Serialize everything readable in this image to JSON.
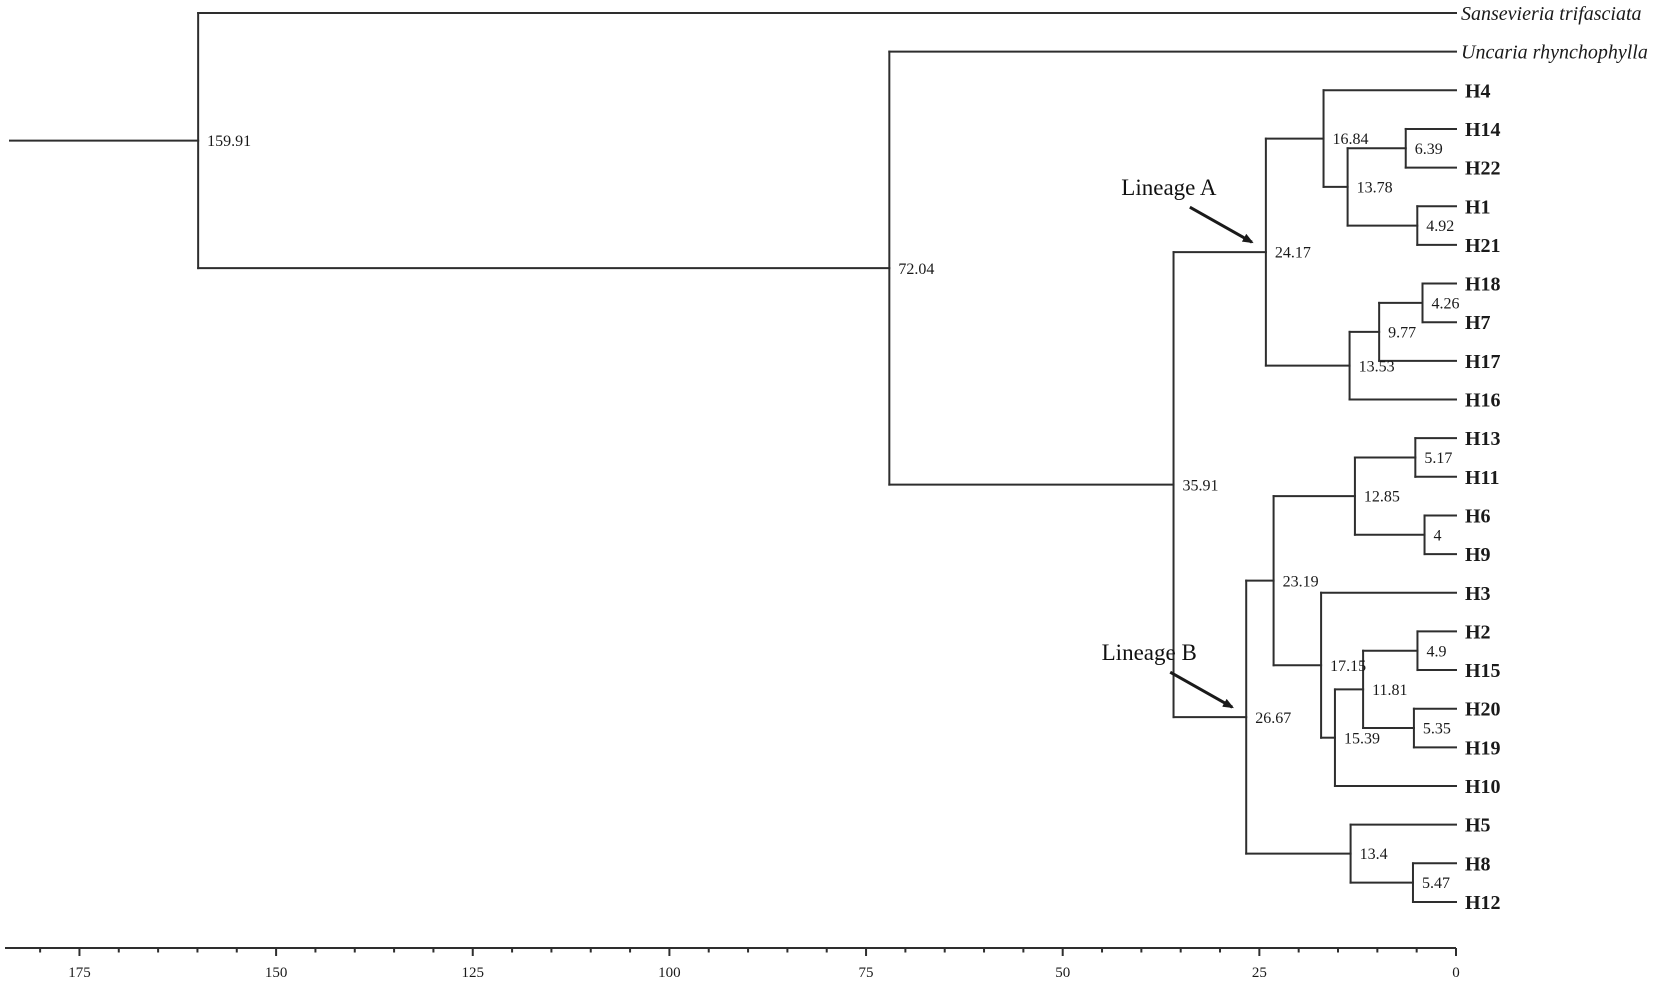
{
  "figure_type": "phylogenetic-tree",
  "colors": {
    "background": "#ffffff",
    "line": "#2e2e2e",
    "text": "#1a1a1a"
  },
  "chart_data": {
    "type": "dendrogram",
    "orientation": "right-facing, time axis decreasing to 0 at tips",
    "axis": {
      "major_ticks": [
        175,
        150,
        125,
        100,
        75,
        50,
        25,
        0
      ],
      "minor_step": 5,
      "minor_max": 180,
      "min": 0,
      "max": 175
    },
    "annotations": [
      {
        "text": "Lineage A",
        "target_label": "24.17"
      },
      {
        "text": "Lineage B",
        "target_label": "26.67"
      }
    ],
    "tip_order": [
      "Sansevieria trifasciata",
      "Uncaria rhynchophylla",
      "H4",
      "H14",
      "H22",
      "H1",
      "H21",
      "H18",
      "H7",
      "H17",
      "H16",
      "H13",
      "H11",
      "H6",
      "H9",
      "H3",
      "H2",
      "H15",
      "H20",
      "H19",
      "H10",
      "H5",
      "H8",
      "H12"
    ],
    "tree": {
      "age": 159.91,
      "label": "159.91",
      "children": [
        {
          "name": "Sansevieria trifasciata",
          "style": "italic"
        },
        {
          "age": 72.04,
          "label": "72.04",
          "children": [
            {
              "name": "Uncaria rhynchophylla",
              "style": "italic"
            },
            {
              "age": 35.91,
              "label": "35.91",
              "children": [
                {
                  "age": 24.17,
                  "label": "24.17",
                  "children": [
                    {
                      "age": 16.84,
                      "label": "16.84",
                      "children": [
                        {
                          "name": "H4"
                        },
                        {
                          "age": 13.78,
                          "label": "13.78",
                          "children": [
                            {
                              "age": 6.39,
                              "label": "6.39",
                              "children": [
                                {
                                  "name": "H14"
                                },
                                {
                                  "name": "H22"
                                }
                              ]
                            },
                            {
                              "age": 4.92,
                              "label": "4.92",
                              "children": [
                                {
                                  "name": "H1"
                                },
                                {
                                  "name": "H21"
                                }
                              ]
                            }
                          ]
                        }
                      ]
                    },
                    {
                      "age": 13.53,
                      "label": "13.53",
                      "children": [
                        {
                          "age": 9.77,
                          "label": "9.77",
                          "children": [
                            {
                              "age": 4.26,
                              "label": "4.26",
                              "children": [
                                {
                                  "name": "H18"
                                },
                                {
                                  "name": "H7"
                                }
                              ]
                            },
                            {
                              "name": "H17"
                            }
                          ]
                        },
                        {
                          "name": "H16"
                        }
                      ]
                    }
                  ]
                },
                {
                  "age": 26.67,
                  "label": "26.67",
                  "children": [
                    {
                      "age": 23.19,
                      "label": "23.19",
                      "children": [
                        {
                          "age": 12.85,
                          "label": "12.85",
                          "children": [
                            {
                              "age": 5.17,
                              "label": "5.17",
                              "children": [
                                {
                                  "name": "H13"
                                },
                                {
                                  "name": "H11"
                                }
                              ]
                            },
                            {
                              "age": 4,
                              "label": "4",
                              "children": [
                                {
                                  "name": "H6"
                                },
                                {
                                  "name": "H9"
                                }
                              ]
                            }
                          ]
                        },
                        {
                          "age": 17.15,
                          "label": "17.15",
                          "children": [
                            {
                              "name": "H3"
                            },
                            {
                              "age": 15.39,
                              "label": "15.39",
                              "children": [
                                {
                                  "age": 11.81,
                                  "label": "11.81",
                                  "children": [
                                    {
                                      "age": 4.9,
                                      "label": "4.9",
                                      "children": [
                                        {
                                          "name": "H2"
                                        },
                                        {
                                          "name": "H15"
                                        }
                                      ]
                                    },
                                    {
                                      "age": 5.35,
                                      "label": "5.35",
                                      "children": [
                                        {
                                          "name": "H20"
                                        },
                                        {
                                          "name": "H19"
                                        }
                                      ]
                                    }
                                  ]
                                },
                                {
                                  "name": "H10"
                                }
                              ]
                            }
                          ]
                        }
                      ]
                    },
                    {
                      "age": 13.4,
                      "label": "13.4",
                      "children": [
                        {
                          "name": "H5"
                        },
                        {
                          "age": 5.47,
                          "label": "5.47",
                          "children": [
                            {
                              "name": "H8"
                            },
                            {
                              "name": "H12"
                            }
                          ]
                        }
                      ]
                    }
                  ]
                }
              ]
            }
          ]
        }
      ]
    }
  }
}
